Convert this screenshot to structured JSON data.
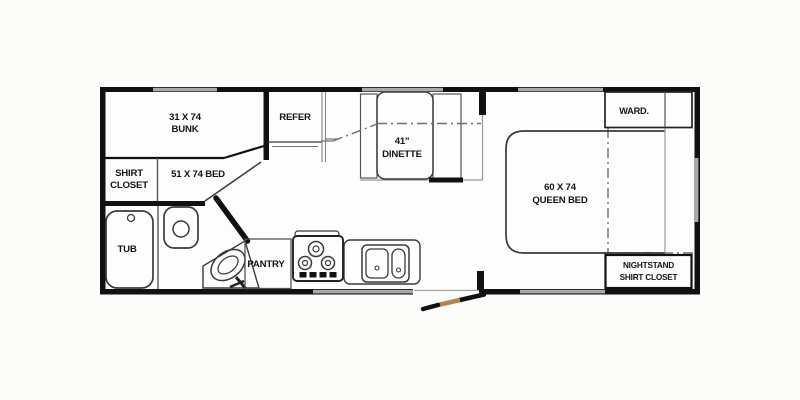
{
  "diagram": {
    "type": "rv-travel-trailer-floorplan",
    "colors": {
      "wall": "#111111",
      "furniture_line": "#3a3a3a",
      "window_gray": "#a9a9a9",
      "slide_dash_line": "#6f6f6f",
      "door_accent": "#ad8a55",
      "background": "#fcfcfb",
      "text": "#141414"
    },
    "rooms": {
      "bunk": {
        "line1": "31 X 74",
        "line2": "BUNK"
      },
      "shirt_closet_front": {
        "line1": "SHIRT",
        "line2": "CLOSET"
      },
      "bed51": {
        "label": "51 X 74 BED"
      },
      "tub": {
        "label": "TUB"
      },
      "refer": {
        "label": "REFER"
      },
      "dinette": {
        "line1": "41\"",
        "line2": "DINETTE"
      },
      "pantry": {
        "label": "PANTRY"
      },
      "queen_bed": {
        "line1": "60 X 74",
        "line2": "QUEEN BED"
      },
      "wardrobe": {
        "label": "WARD."
      },
      "nightstand": {
        "line1": "NIGHTSTAND",
        "line2": "SHIRT CLOSET"
      }
    }
  }
}
